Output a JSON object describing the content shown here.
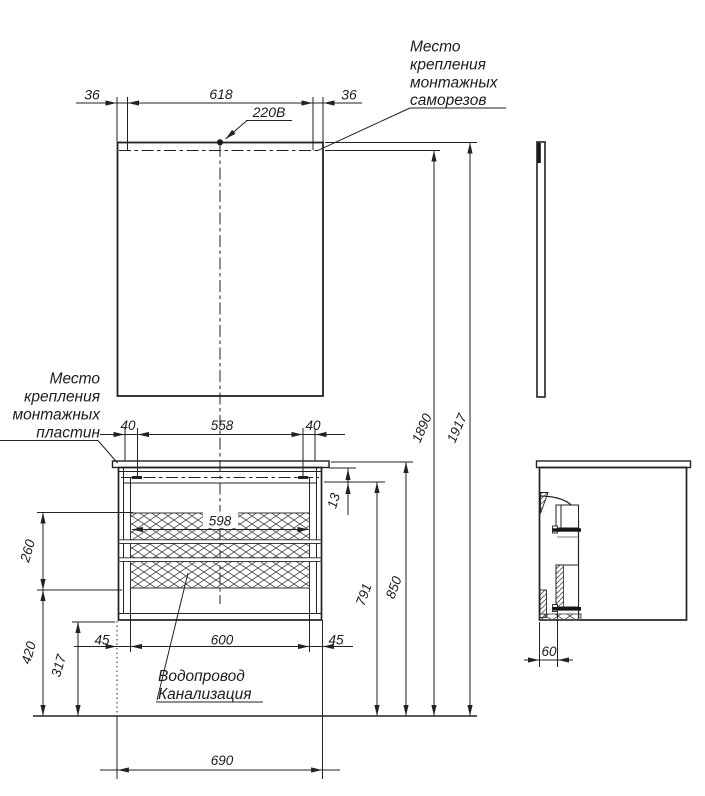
{
  "drawing_title": "Mirror and vanity cabinet installation drawing",
  "annotations": {
    "screws_note": {
      "lines": [
        "Место",
        "крепления",
        "монтажных",
        "саморезов"
      ]
    },
    "plates_note": {
      "lines": [
        "Место",
        "крепления",
        "монтажных",
        "пластин"
      ]
    },
    "plumbing_note": {
      "lines": [
        "Водопровод",
        "Канализация"
      ]
    },
    "power_label": "220В"
  },
  "dimensions": {
    "mirror_left_offset": "36",
    "mirror_screw_span": "618",
    "mirror_right_offset": "36",
    "plate_left_offset": "40",
    "plate_span": "558",
    "plate_right_offset": "40",
    "drawer_front_width": "598",
    "drawer_stack_height": "260",
    "front_bottom_height": "420",
    "pipe_height": "317",
    "front_left_margin": "45",
    "front_opening": "600",
    "front_right_margin": "45",
    "total_width": "690",
    "top_inset": "13",
    "carcass_top_height": "791",
    "worktop_height": "850",
    "screw_line_height": "1890",
    "mirror_top_height": "1917",
    "wall_offset": "60"
  },
  "colors": {
    "line": "#222222",
    "background": "#ffffff",
    "hatch": "#4a4a4a"
  }
}
